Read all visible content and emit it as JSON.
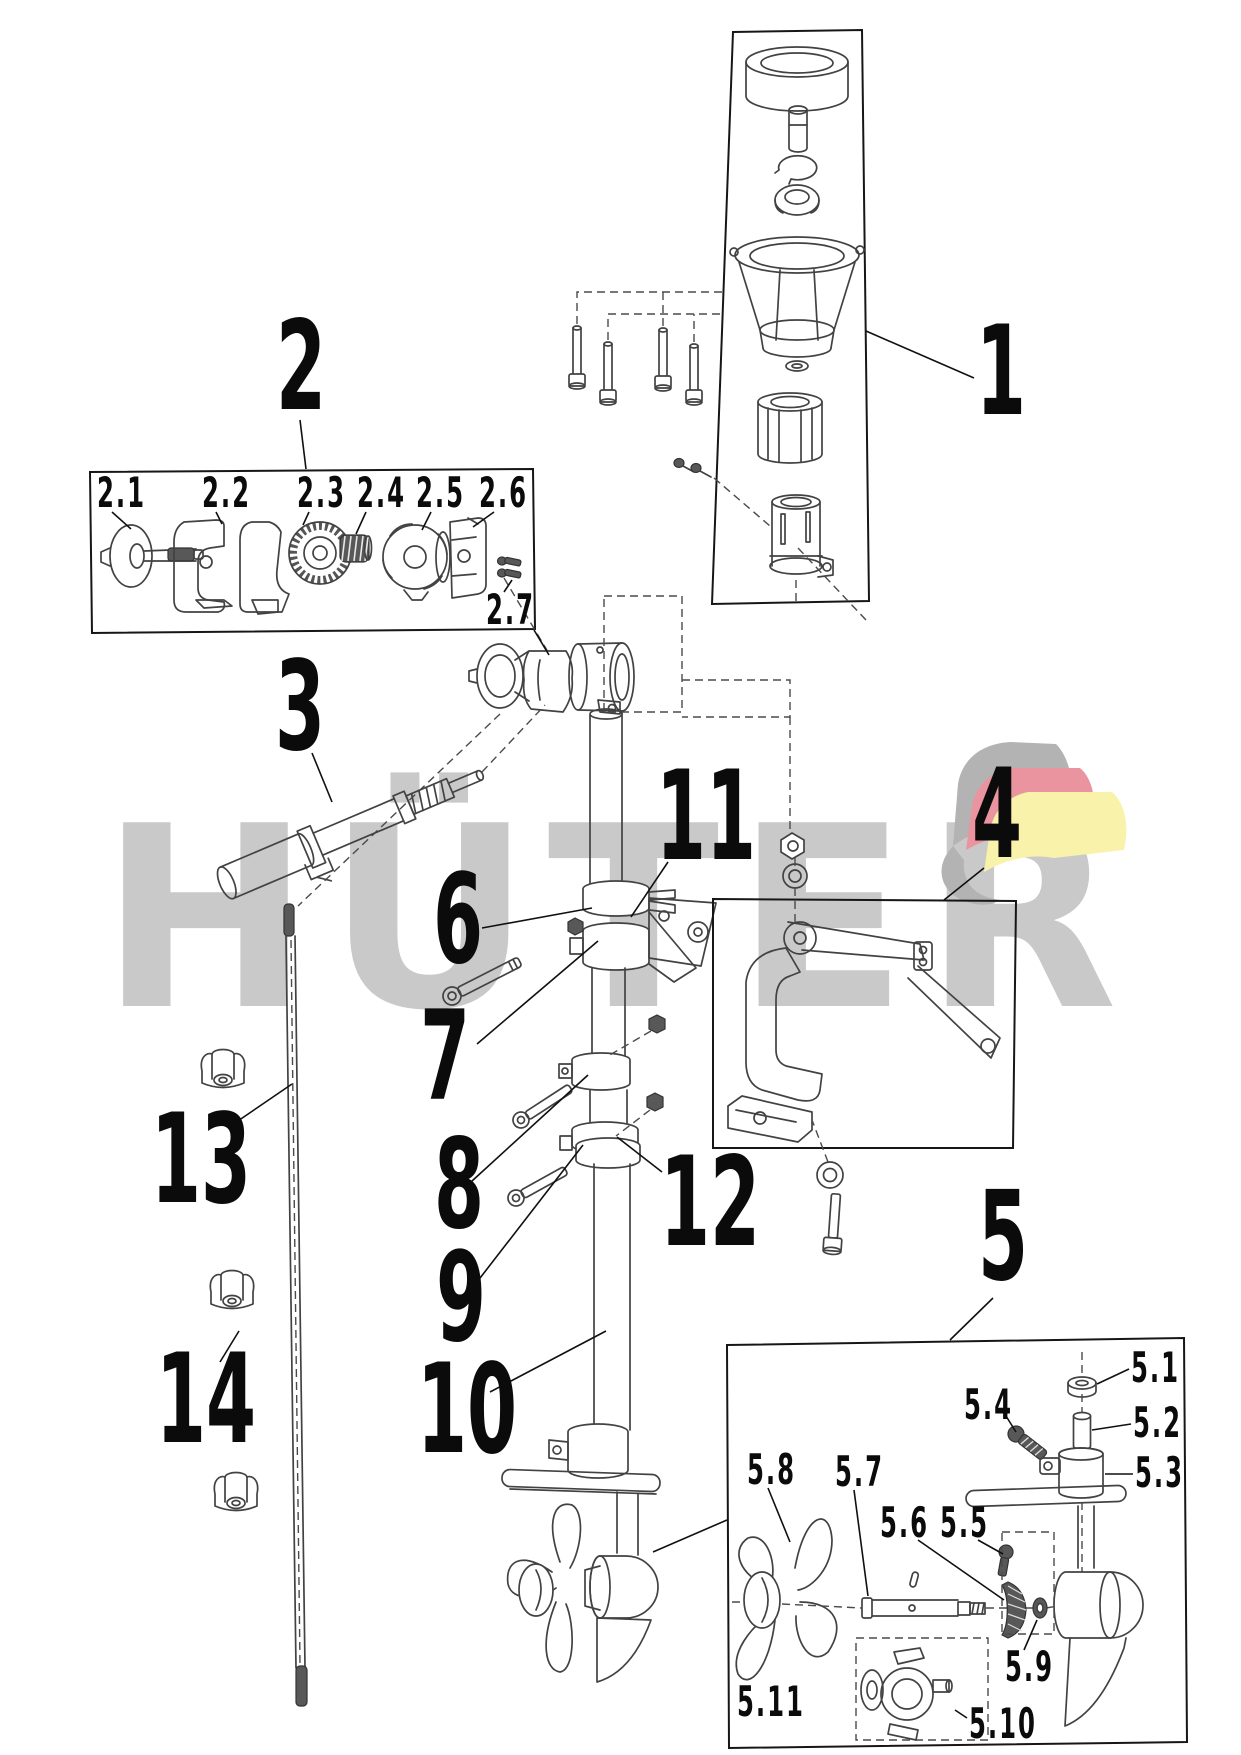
{
  "page": {
    "background": "#ffffff"
  },
  "watermark": {
    "text": "HÜTER",
    "color": "#c9c9c9",
    "flag": {
      "gray": "#b3b3b3",
      "red": "#e9949f",
      "yellow": "#f8f2aa"
    }
  },
  "callouts": [
    {
      "id": "1",
      "label": "1"
    },
    {
      "id": "2",
      "label": "2"
    },
    {
      "id": "3",
      "label": "3"
    },
    {
      "id": "4",
      "label": "4"
    },
    {
      "id": "5",
      "label": "5"
    },
    {
      "id": "6",
      "label": "6"
    },
    {
      "id": "7",
      "label": "7"
    },
    {
      "id": "8",
      "label": "8"
    },
    {
      "id": "9",
      "label": "9"
    },
    {
      "id": "10",
      "label": "10"
    },
    {
      "id": "11",
      "label": "11"
    },
    {
      "id": "12",
      "label": "12"
    },
    {
      "id": "13",
      "label": "13"
    },
    {
      "id": "14",
      "label": "14"
    },
    {
      "id": "2.1",
      "label": "2.1"
    },
    {
      "id": "2.2",
      "label": "2.2"
    },
    {
      "id": "2.3",
      "label": "2.3"
    },
    {
      "id": "2.4",
      "label": "2.4"
    },
    {
      "id": "2.5",
      "label": "2.5"
    },
    {
      "id": "2.6",
      "label": "2.6"
    },
    {
      "id": "2.7",
      "label": "2.7"
    },
    {
      "id": "5.1",
      "label": "5.1"
    },
    {
      "id": "5.2",
      "label": "5.2"
    },
    {
      "id": "5.3",
      "label": "5.3"
    },
    {
      "id": "5.4",
      "label": "5.4"
    },
    {
      "id": "5.5",
      "label": "5.5"
    },
    {
      "id": "5.6",
      "label": "5.6"
    },
    {
      "id": "5.7",
      "label": "5.7"
    },
    {
      "id": "5.8",
      "label": "5.8"
    },
    {
      "id": "5.9",
      "label": "5.9"
    },
    {
      "id": "5.10",
      "label": "5.10"
    },
    {
      "id": "5.11",
      "label": "5.11"
    }
  ]
}
